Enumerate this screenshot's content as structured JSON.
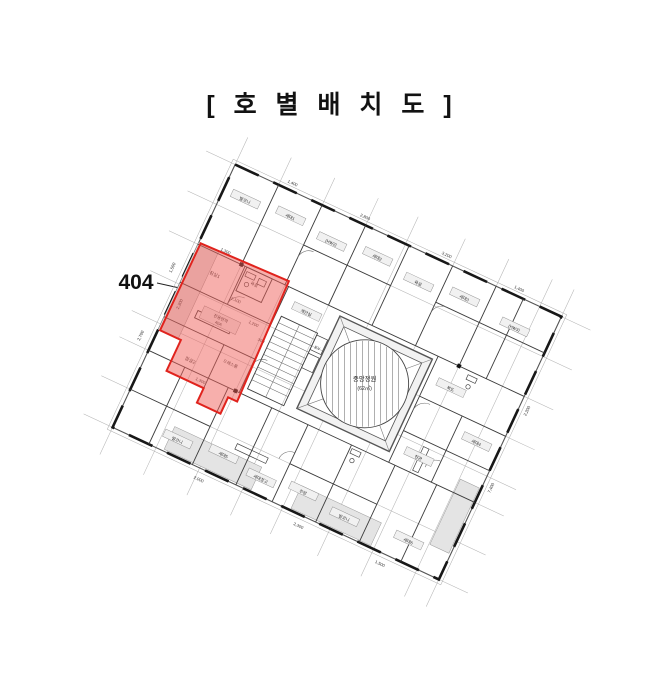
{
  "title": "[ 호 별 배 치 도 ]",
  "unit": {
    "number": "404",
    "highlight_fill": "rgba(240,95,90,0.5)",
    "highlight_border": "#e0231d"
  },
  "plan": {
    "core": {
      "label_line1": "중앙정원",
      "label_line2": "(62㎡)",
      "elevator_label": "EV"
    },
    "pills": [
      "발코니",
      "세대1",
      "(HW2)",
      "세대2",
      "욕실",
      "세대3",
      "(HW3)",
      "복도",
      "세대4",
      "현관",
      "발코니",
      "세대5",
      "세대창고",
      "주방",
      "발코니",
      "세대6",
      "계단실"
    ],
    "unit_rooms": [
      "침실1",
      "욕실",
      "드레스룸",
      "침실2",
      "전용면적",
      "40A"
    ],
    "dims_inside": [
      "1,300",
      "2,100",
      "1,200",
      "300",
      "1,300",
      "2,300"
    ],
    "dims_outside": [
      "1,400",
      "2,800",
      "3,200",
      "1,400",
      "2,000",
      "2,300",
      "1,500",
      "2,200",
      "7,400",
      "1,500",
      "2,700"
    ]
  }
}
